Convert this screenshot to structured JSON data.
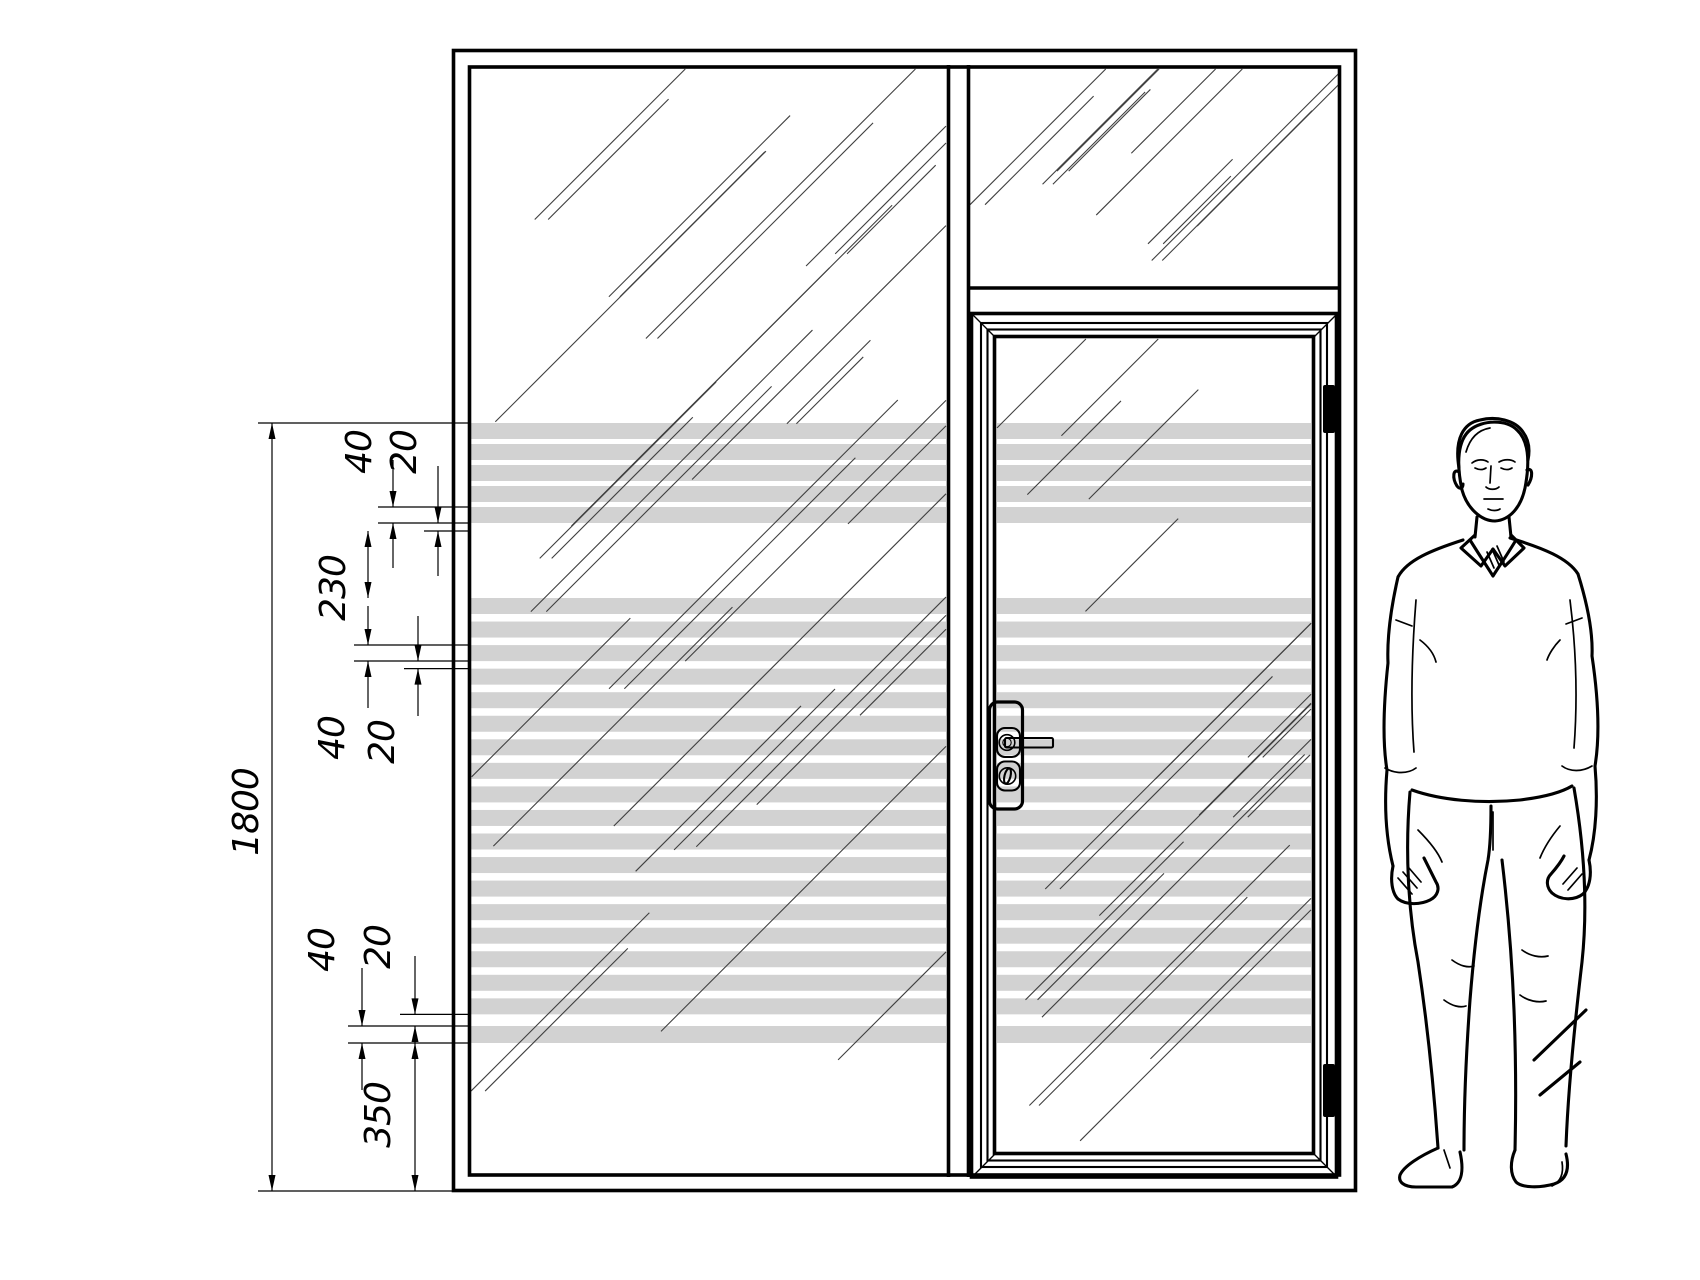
{
  "dims": {
    "overall": "1800",
    "top_stripe": "40",
    "top_gap": "20",
    "clear_band": "230",
    "mid_stripe": "40",
    "mid_gap": "20",
    "bottom_stripe": "40",
    "bottom_gap": "20",
    "bottom_offset": "350"
  },
  "colors": {
    "background": "#ffffff",
    "line": "#000000",
    "stripe": "#d2d2d2",
    "reflection": "#3f3f3f"
  }
}
